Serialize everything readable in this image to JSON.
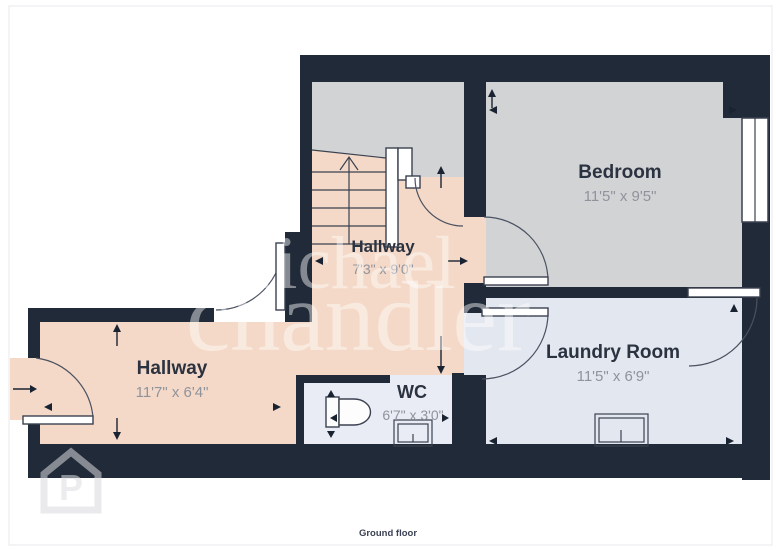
{
  "floor_label": "Ground floor",
  "watermark": {
    "line1": "Michael",
    "line2": "chandler",
    "logo_letter": "P"
  },
  "rooms": [
    {
      "id": "hallway-upper",
      "name": "Hallway",
      "dims": "7'3\" x 9'0\""
    },
    {
      "id": "bedroom",
      "name": "Bedroom",
      "dims": "11'5\" x 9'5\""
    },
    {
      "id": "hallway-lower",
      "name": "Hallway",
      "dims": "11'7\" x 6'4\""
    },
    {
      "id": "laundry-room",
      "name": "Laundry Room",
      "dims": "11'5\" x 6'9\""
    },
    {
      "id": "wc",
      "name": "WC",
      "dims": "6'7\" x 3'0\""
    }
  ],
  "colors": {
    "wall": "#212a38",
    "hallway_floor": "#f5d9c8",
    "bedroom_floor": "#d2d3d5",
    "laundry_floor": "#e3e7ef",
    "wc_floor": "#e9ecf4",
    "label_color": "#2b3240",
    "dims_color": "#8f939c"
  }
}
